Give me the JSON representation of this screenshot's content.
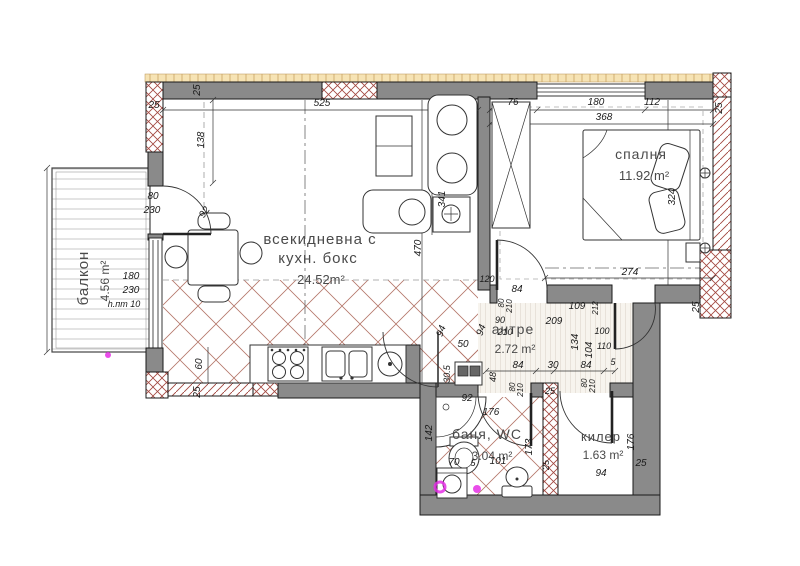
{
  "plan": {
    "title": "apartment-floor-plan",
    "colors": {
      "wall_gray": "#8a8a8a",
      "hatch_red": "#a2463e",
      "tile_red": "#b5776a",
      "insulation_tan": "#f6e3b4",
      "stripe_floor": "#d9d1c5",
      "watermark_magenta": "#e52ee5",
      "line_black": "#1a1a1a"
    },
    "rooms": [
      {
        "id": "balcony",
        "name": "балкон",
        "area": "4.56 m²",
        "x": 88,
        "y": 278,
        "ax": 109,
        "ay": 281,
        "rot": -90,
        "ns": 15,
        "as": 12
      },
      {
        "id": "living",
        "name": "всекидневна с",
        "name2": "кухн. бокс",
        "x2": 318,
        "y2": 263,
        "area": "24.52m²",
        "x": 320,
        "y": 244,
        "ax": 321,
        "ay": 284,
        "ns": 15,
        "as": 13
      },
      {
        "id": "bedroom",
        "name": "спалня",
        "area": "11.92 m²",
        "x": 641,
        "y": 159,
        "ax": 644,
        "ay": 180,
        "ns": 14,
        "as": 13
      },
      {
        "id": "hallway",
        "name": "антре",
        "area": "2.72 m²",
        "x": 513,
        "y": 334,
        "ax": 515,
        "ay": 353,
        "ns": 14,
        "as": 12
      },
      {
        "id": "bathroom",
        "name": "баня, WC",
        "area": "3.04 m²",
        "x": 487,
        "y": 439,
        "ax": 492,
        "ay": 460,
        "ns": 14,
        "as": 12
      },
      {
        "id": "closet",
        "name": "килер",
        "area": "1.63 m²",
        "x": 601,
        "y": 441,
        "ax": 603,
        "ay": 459,
        "ns": 13,
        "as": 12
      }
    ],
    "dims": [
      {
        "t": "25",
        "x": 200,
        "y": 90,
        "r": -90
      },
      {
        "t": "25",
        "x": 154,
        "y": 108
      },
      {
        "t": "138",
        "x": 204,
        "y": 140,
        "r": -90
      },
      {
        "t": "525",
        "x": 322,
        "y": 106
      },
      {
        "t": "92",
        "x": 207,
        "y": 214,
        "r": -55
      },
      {
        "t": "80",
        "x": 153,
        "y": 199
      },
      {
        "t": "230",
        "x": 152,
        "y": 213
      },
      {
        "t": "180",
        "x": 131,
        "y": 279
      },
      {
        "t": "230",
        "x": 131,
        "y": 293
      },
      {
        "t": "h.пт 10",
        "x": 124,
        "y": 307,
        "s": 9
      },
      {
        "t": "76",
        "x": 513,
        "y": 105
      },
      {
        "t": "180",
        "x": 596,
        "y": 105
      },
      {
        "t": "112",
        "x": 652,
        "y": 105
      },
      {
        "t": "368",
        "x": 604,
        "y": 120
      },
      {
        "t": "25",
        "x": 722,
        "y": 108,
        "r": -90
      },
      {
        "t": "341",
        "x": 445,
        "y": 199,
        "r": -90
      },
      {
        "t": "470",
        "x": 421,
        "y": 248,
        "r": -90
      },
      {
        "t": "324",
        "x": 675,
        "y": 197,
        "r": -90
      },
      {
        "t": "274",
        "x": 630,
        "y": 275
      },
      {
        "t": "25",
        "x": 699,
        "y": 307,
        "r": -90
      },
      {
        "t": "60",
        "x": 202,
        "y": 364,
        "r": -90
      },
      {
        "t": "25",
        "x": 200,
        "y": 392,
        "r": -90
      },
      {
        "t": "120",
        "x": 487,
        "y": 282,
        "s": 9
      },
      {
        "t": "84",
        "x": 517,
        "y": 292
      },
      {
        "t": "80",
        "x": 504,
        "y": 303,
        "r": -90,
        "s": 8
      },
      {
        "t": "210",
        "x": 512,
        "y": 306,
        "r": -90,
        "s": 8
      },
      {
        "t": "109",
        "x": 577,
        "y": 309
      },
      {
        "t": "212",
        "x": 598,
        "y": 308,
        "r": -90,
        "s": 8
      },
      {
        "t": "209",
        "x": 554,
        "y": 324
      },
      {
        "t": "90",
        "x": 500,
        "y": 323,
        "s": 9
      },
      {
        "t": "210",
        "x": 505,
        "y": 335,
        "s": 9
      },
      {
        "t": "94",
        "x": 484,
        "y": 331,
        "r": -70
      },
      {
        "t": "134",
        "x": 578,
        "y": 342,
        "r": -90
      },
      {
        "t": "104",
        "x": 592,
        "y": 350,
        "r": -90
      },
      {
        "t": "100",
        "x": 602,
        "y": 334,
        "s": 9
      },
      {
        "t": "110",
        "x": 604,
        "y": 349,
        "s": 9
      },
      {
        "t": "5",
        "x": 613,
        "y": 365,
        "s": 9
      },
      {
        "t": "94",
        "x": 444,
        "y": 332,
        "r": -70
      },
      {
        "t": "50",
        "x": 463,
        "y": 347
      },
      {
        "t": "30.5",
        "x": 450,
        "y": 374,
        "r": -90,
        "s": 9
      },
      {
        "t": "48",
        "x": 496,
        "y": 377,
        "r": -90,
        "s": 9
      },
      {
        "t": "92",
        "x": 467,
        "y": 401
      },
      {
        "t": "176",
        "x": 491,
        "y": 415
      },
      {
        "t": "84",
        "x": 518,
        "y": 368
      },
      {
        "t": "30",
        "x": 553,
        "y": 368
      },
      {
        "t": "84",
        "x": 586,
        "y": 368
      },
      {
        "t": "80",
        "x": 587,
        "y": 383,
        "r": -90,
        "s": 8
      },
      {
        "t": "210",
        "x": 595,
        "y": 386,
        "r": -90,
        "s": 8
      },
      {
        "t": "80",
        "x": 515,
        "y": 387,
        "r": -90,
        "s": 8
      },
      {
        "t": "210",
        "x": 523,
        "y": 390,
        "r": -90,
        "s": 8
      },
      {
        "t": "142",
        "x": 432,
        "y": 433,
        "r": -90
      },
      {
        "t": "173",
        "x": 532,
        "y": 447,
        "r": -90
      },
      {
        "t": "70",
        "x": 454,
        "y": 465
      },
      {
        "t": "5",
        "x": 473,
        "y": 466,
        "s": 9
      },
      {
        "t": "101",
        "x": 498,
        "y": 464
      },
      {
        "t": "25",
        "x": 550,
        "y": 394,
        "s": 9
      },
      {
        "t": "25",
        "x": 549,
        "y": 465,
        "r": -90,
        "s": 9
      },
      {
        "t": "94",
        "x": 601,
        "y": 476
      },
      {
        "t": "176",
        "x": 634,
        "y": 442,
        "r": -90
      },
      {
        "t": "25",
        "x": 641,
        "y": 466
      }
    ]
  }
}
